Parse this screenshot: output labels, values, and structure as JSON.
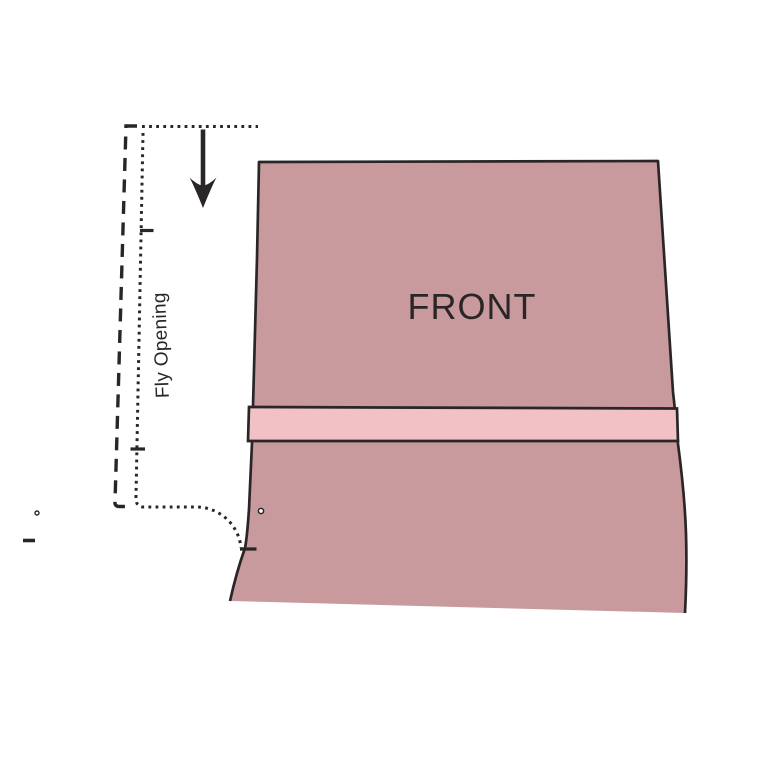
{
  "diagram": {
    "piece_label": "FRONT",
    "fly_label": "Fly Opening"
  },
  "icons": {
    "arrow": "down-arrow-icon",
    "notches": "notch-tick-marks",
    "dots": "drill-dot-marks"
  },
  "colors": {
    "background": "#ffffff",
    "piece_fill": "#c89a9d",
    "band_fill": "#f2c1c5",
    "line": "#2a2627",
    "text": "#2a2627",
    "dot_fill": "#ffffff"
  }
}
